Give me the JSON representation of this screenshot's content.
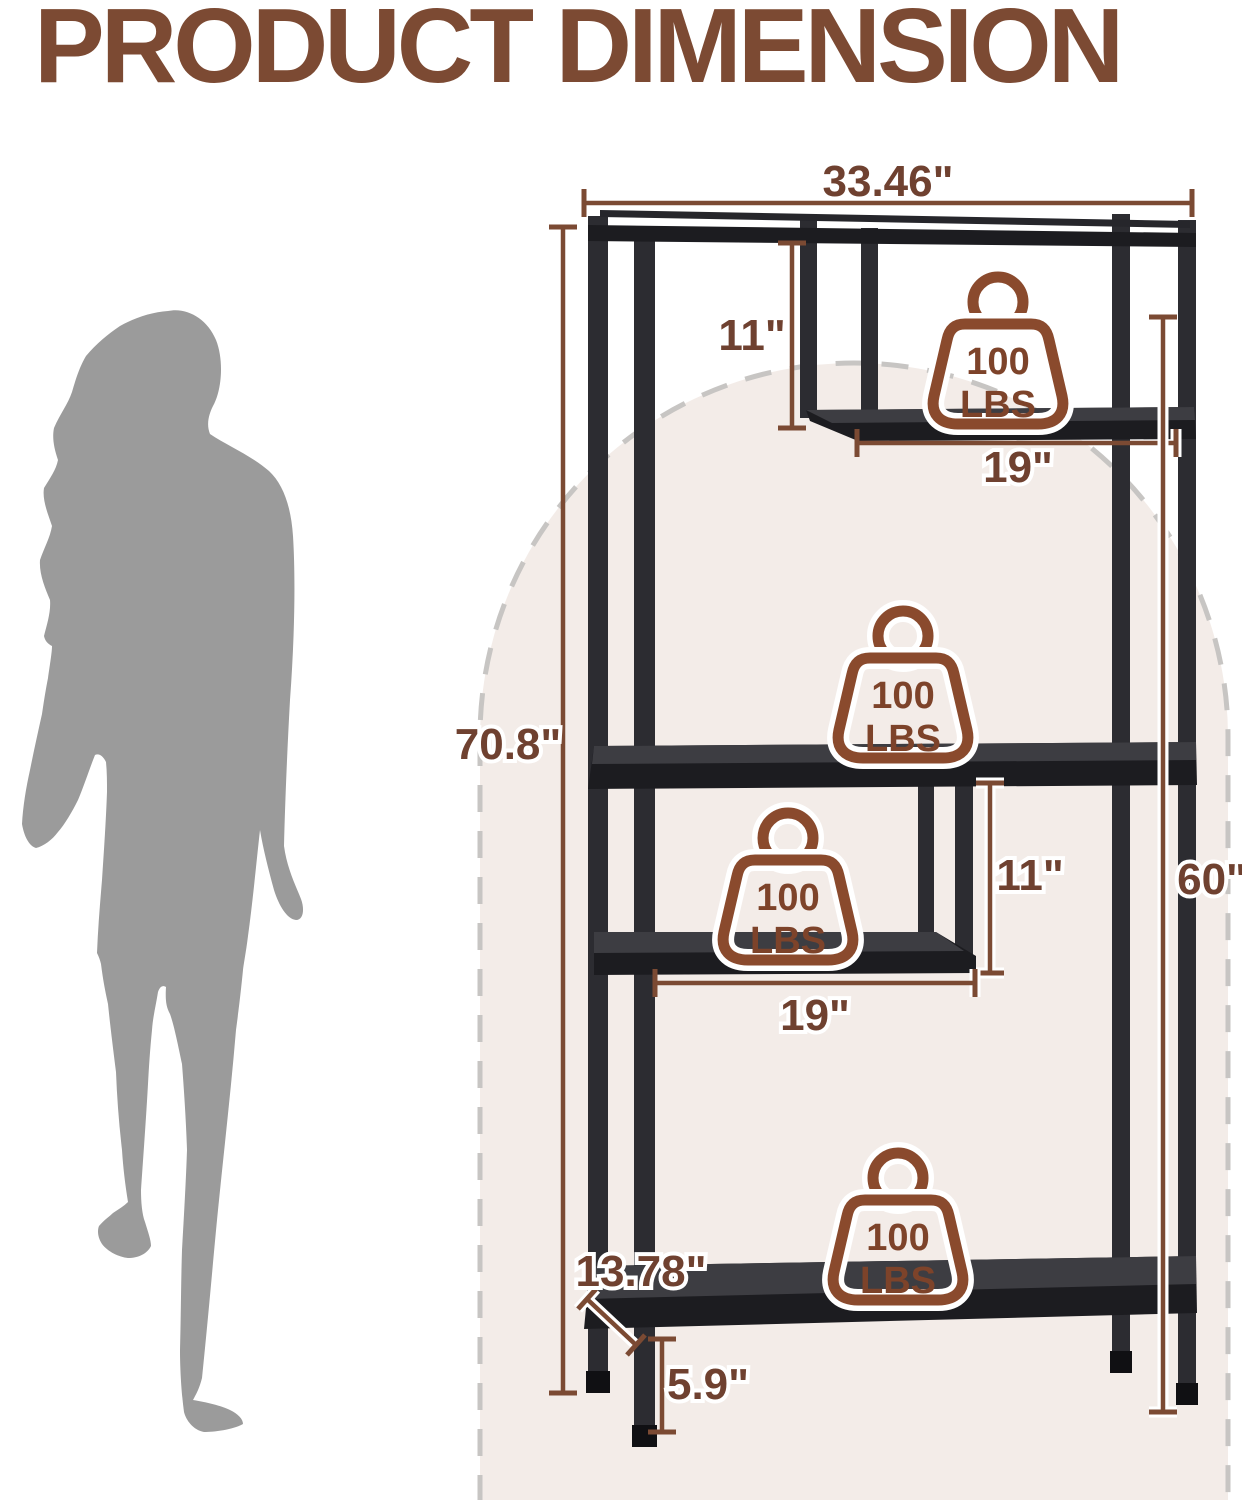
{
  "title": "PRODUCT DIMENSION",
  "dimensions": {
    "overall_width": "33.46\"",
    "overall_height": "70.8\"",
    "upper_compartment_height": "11\"",
    "upper_shelf_width": "19\"",
    "right_height": "60\"",
    "middle_compartment_height": "11\"",
    "middle_shelf_width": "19\"",
    "depth": "13.78\"",
    "ground_clearance": "5.9\""
  },
  "weight_capacity": {
    "value": "100",
    "unit": "LBS",
    "shelves_marked": 4
  },
  "colors": {
    "title_brown": "#7c4a33",
    "dimension_line_brown": "#7b4a33",
    "dimension_text_brown": "#6f4130",
    "weight_icon_brown": "#8a4a2d",
    "frame_black": "#1c1c20",
    "arch_fill": "#f3ece8",
    "arch_dash_gray": "#c7c5c3",
    "silhouette_gray": "#9b9b9b"
  }
}
